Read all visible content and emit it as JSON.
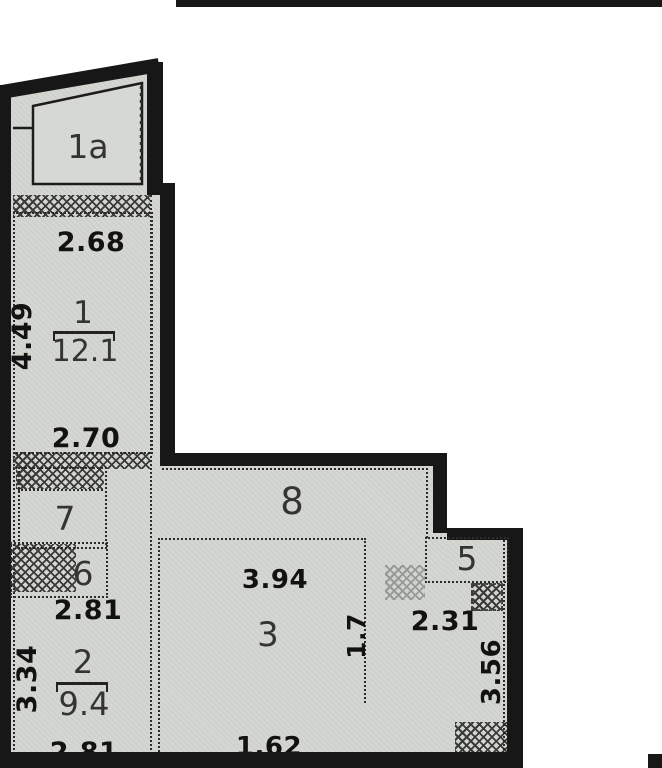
{
  "floor_plan": {
    "balcony": {
      "number": "1a"
    },
    "room1": {
      "number": "1",
      "area": "12.1",
      "width_top": "2.68",
      "depth_left": "4.49",
      "width_bottom": "2.70"
    },
    "room2": {
      "number": "2",
      "area": "9.4",
      "width_top": "2.81",
      "depth_left": "3.34",
      "width_bottom": "2.81"
    },
    "room3": {
      "number": "3",
      "width_top": "3.94",
      "depth_right": "1.7",
      "width_bottom": "1.62"
    },
    "room5": {
      "number": "5",
      "width_top": "2.31",
      "depth_right": "3.56"
    },
    "room6": {
      "number": "6"
    },
    "room7": {
      "number": "7"
    },
    "corridor": {
      "number": "8"
    }
  }
}
